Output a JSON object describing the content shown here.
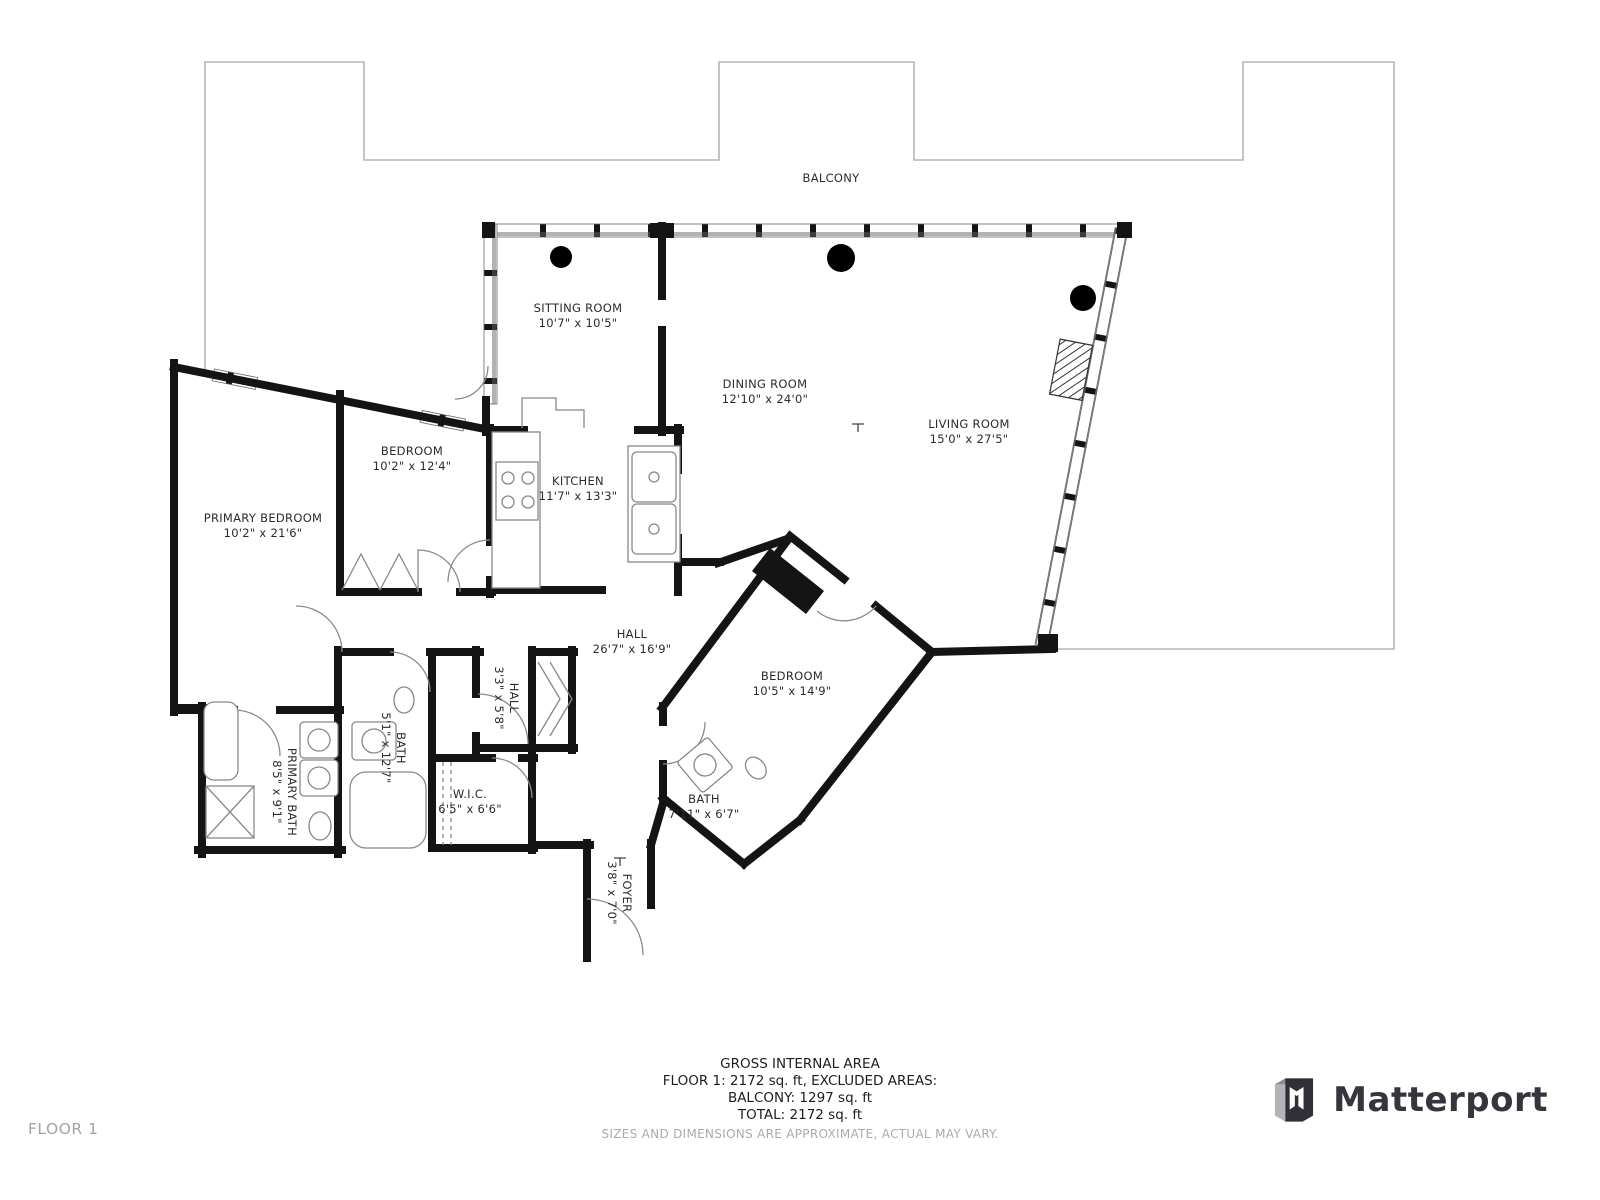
{
  "rooms": {
    "balcony": {
      "name": "BALCONY",
      "dims": ""
    },
    "sitting": {
      "name": "SITTING ROOM",
      "dims": "10'7\" x 10'5\""
    },
    "dining": {
      "name": "DINING ROOM",
      "dims": "12'10\" x 24'0\""
    },
    "living": {
      "name": "LIVING ROOM",
      "dims": "15'0\" x 27'5\""
    },
    "bedroom1": {
      "name": "BEDROOM",
      "dims": "10'2\" x 12'4\""
    },
    "kitchen": {
      "name": "KITCHEN",
      "dims": "11'7\" x 13'3\""
    },
    "primary_bedroom": {
      "name": "PRIMARY BEDROOM",
      "dims": "10'2\" x 21'6\""
    },
    "hall": {
      "name": "HALL",
      "dims": "26'7\" x 16'9\""
    },
    "bedroom2": {
      "name": "BEDROOM",
      "dims": "10'5\" x 14'9\""
    },
    "hall2": {
      "name": "HALL",
      "dims": "3'3\" x 5'8\""
    },
    "bath": {
      "name": "BATH",
      "dims": "5'1\" x 12'7\""
    },
    "primary_bath": {
      "name": "PRIMARY BATH",
      "dims": "8'5\" x 9'1\""
    },
    "wic": {
      "name": "W.I.C.",
      "dims": "6'5\" x 6'6\""
    },
    "bath2": {
      "name": "BATH",
      "dims": "7'11\" x 6'7\""
    },
    "foyer": {
      "name": "FOYER",
      "dims": "3'8\" x 7'0\""
    }
  },
  "footer": {
    "line1": "GROSS INTERNAL AREA",
    "line2": "FLOOR 1: 2172 sq. ft, EXCLUDED AREAS:",
    "line3": "BALCONY: 1297 sq. ft",
    "line4": "TOTAL: 2172 sq. ft",
    "disclaimer": "SIZES AND DIMENSIONS ARE APPROXIMATE, ACTUAL MAY VARY."
  },
  "floor_label": "FLOOR 1",
  "brand": {
    "wordmark": "Matterport"
  },
  "colors": {
    "wall": "#141414",
    "balcony_outline": "#b5b5b5",
    "label_text": "#2b2b2b",
    "muted_text": "#ababab",
    "brand_dark": "#35353d"
  }
}
